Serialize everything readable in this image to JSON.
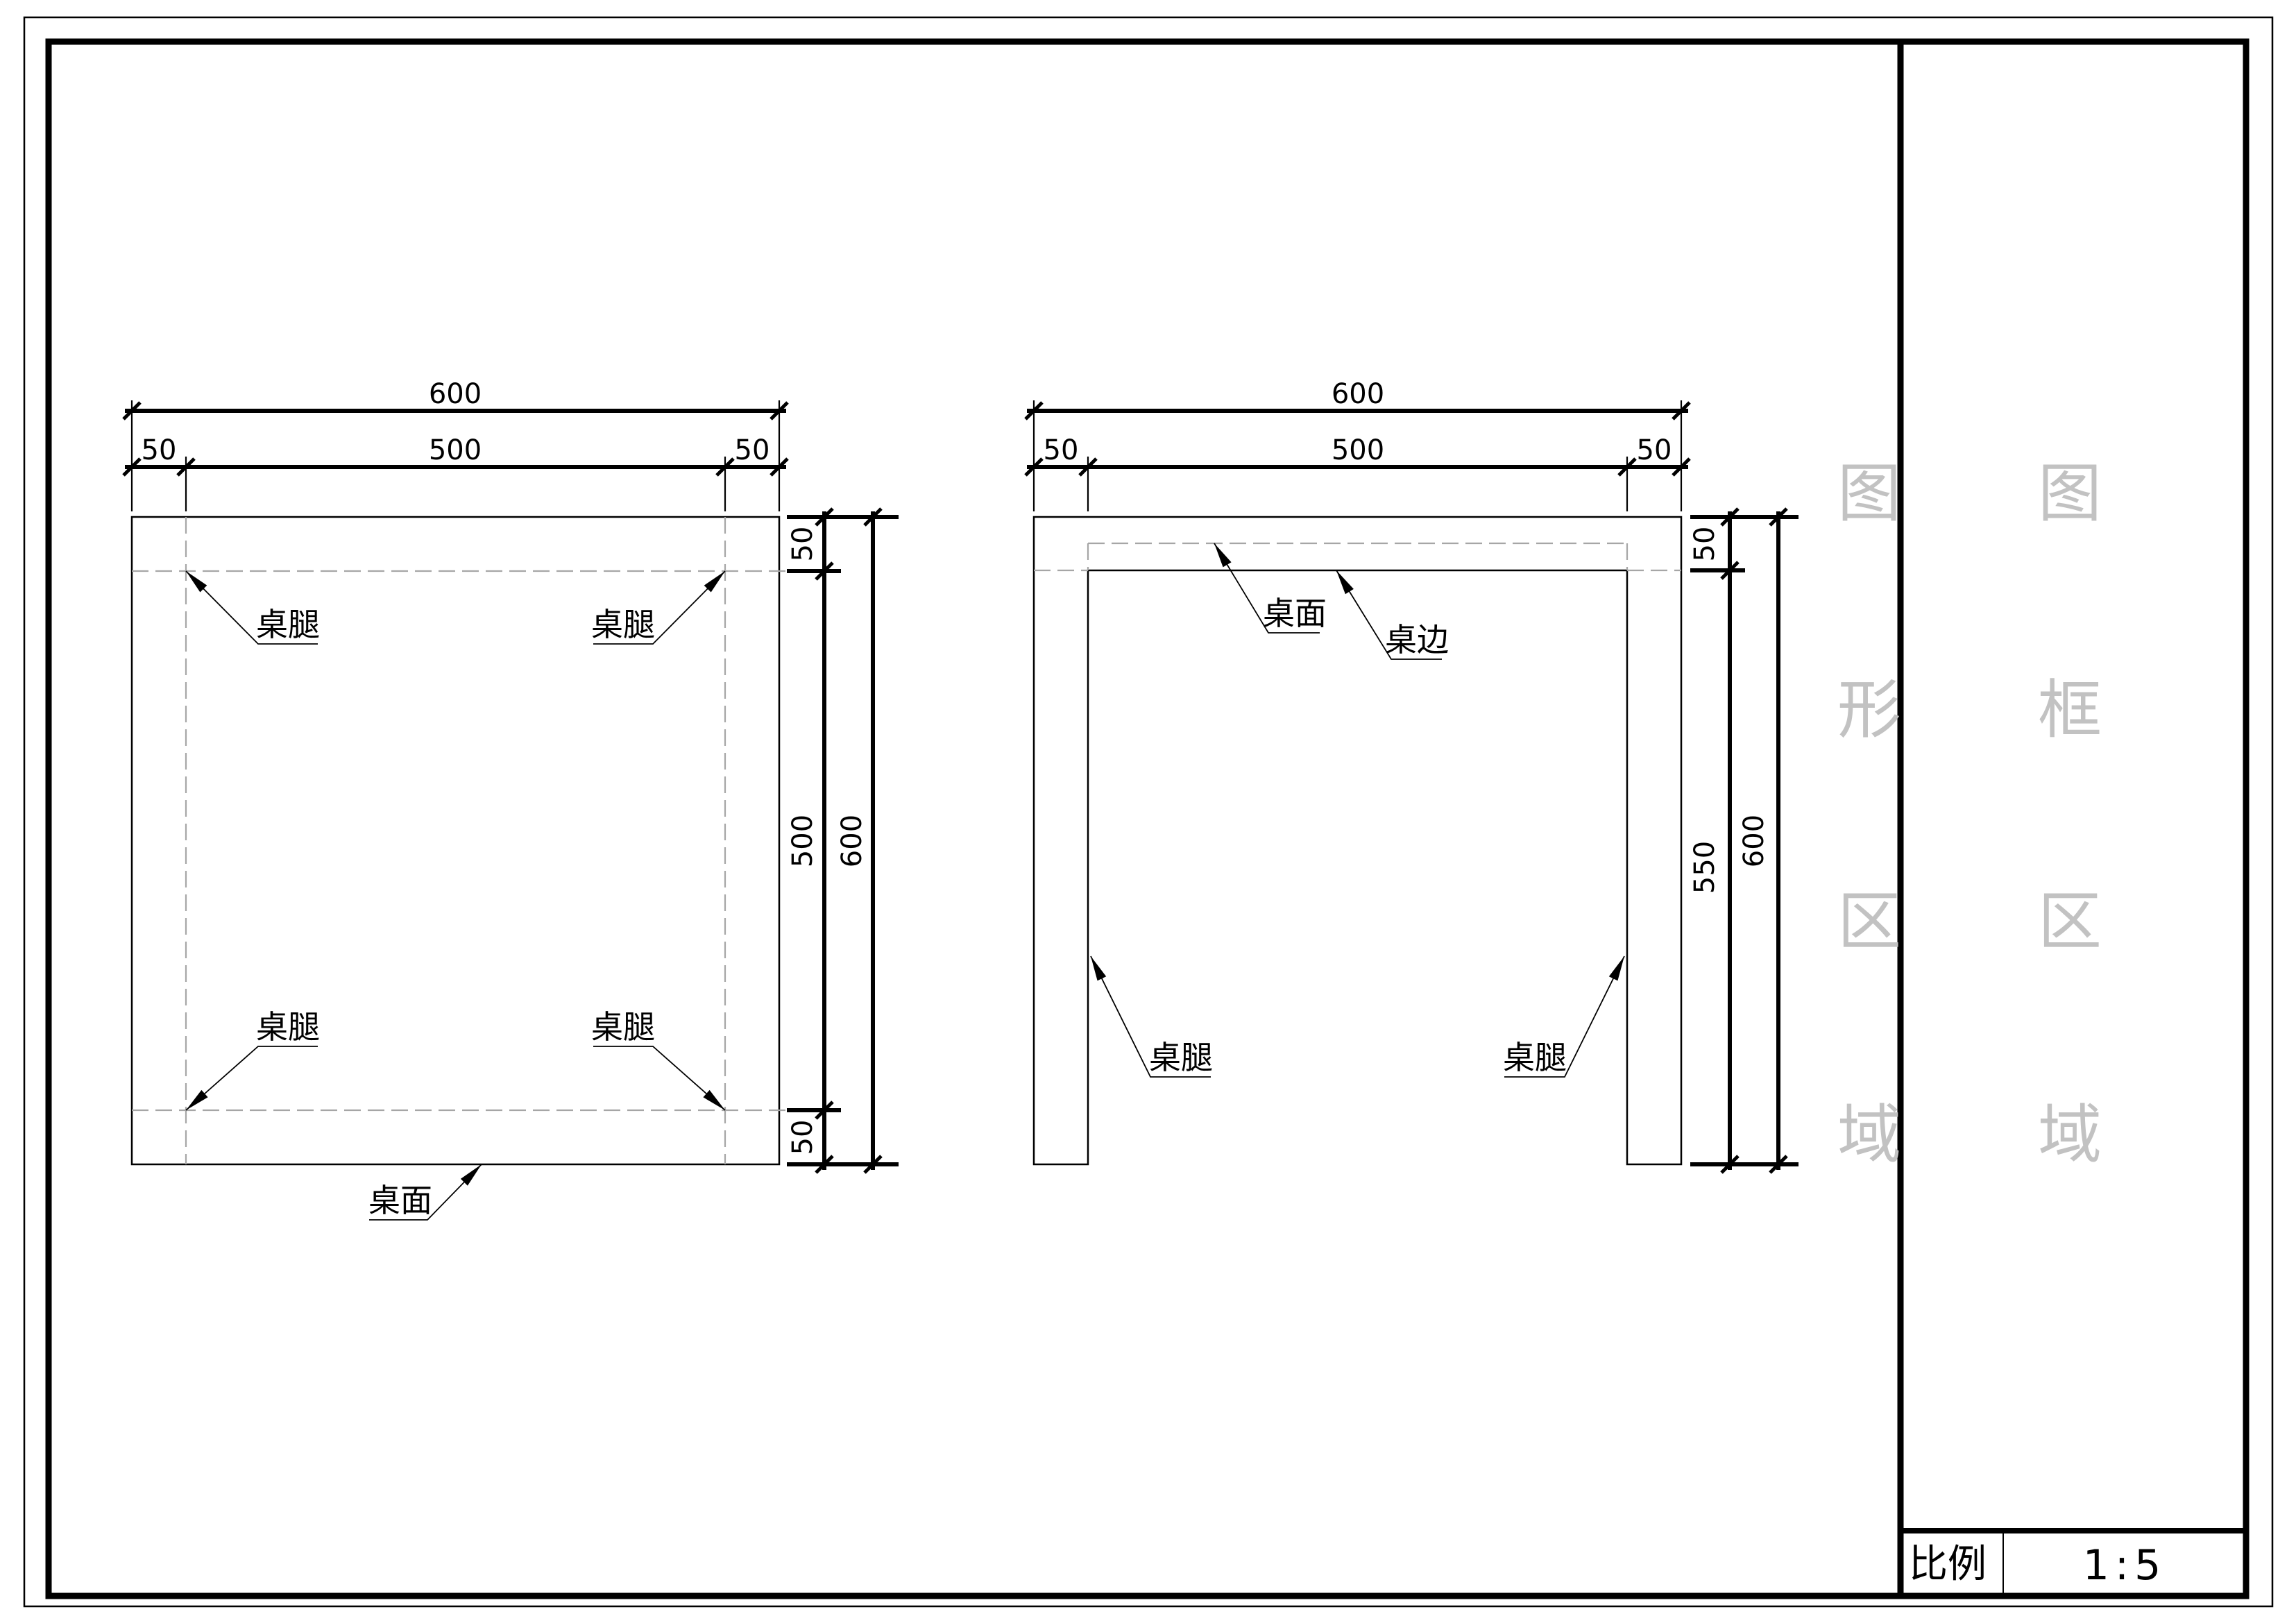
{
  "title_block": {
    "scale_label": "比例",
    "scale_value": "1:5"
  },
  "watermark": {
    "column_graphics": [
      "图",
      "形",
      "区",
      "域"
    ],
    "column_frame": [
      "图",
      "框",
      "区",
      "域"
    ]
  },
  "labels": {
    "table_leg": "桌腿",
    "table_top": "桌面",
    "table_edge": "桌边"
  },
  "plan_view": {
    "dims": {
      "overall_width": "600",
      "inner_width": "500",
      "edge_left": "50",
      "edge_right": "50",
      "overall_height": "600",
      "inner_height": "500",
      "edge_top": "50",
      "edge_bottom": "50"
    }
  },
  "front_view": {
    "dims": {
      "overall_width": "600",
      "inner_width": "500",
      "edge_left": "50",
      "edge_right": "50",
      "overall_height": "600",
      "leg_height": "550",
      "top_thickness": "50"
    }
  },
  "colors": {
    "line": "#000000",
    "hidden_line": "#a6a6a6",
    "watermark": "#c2c2c2",
    "background": "#ffffff"
  }
}
